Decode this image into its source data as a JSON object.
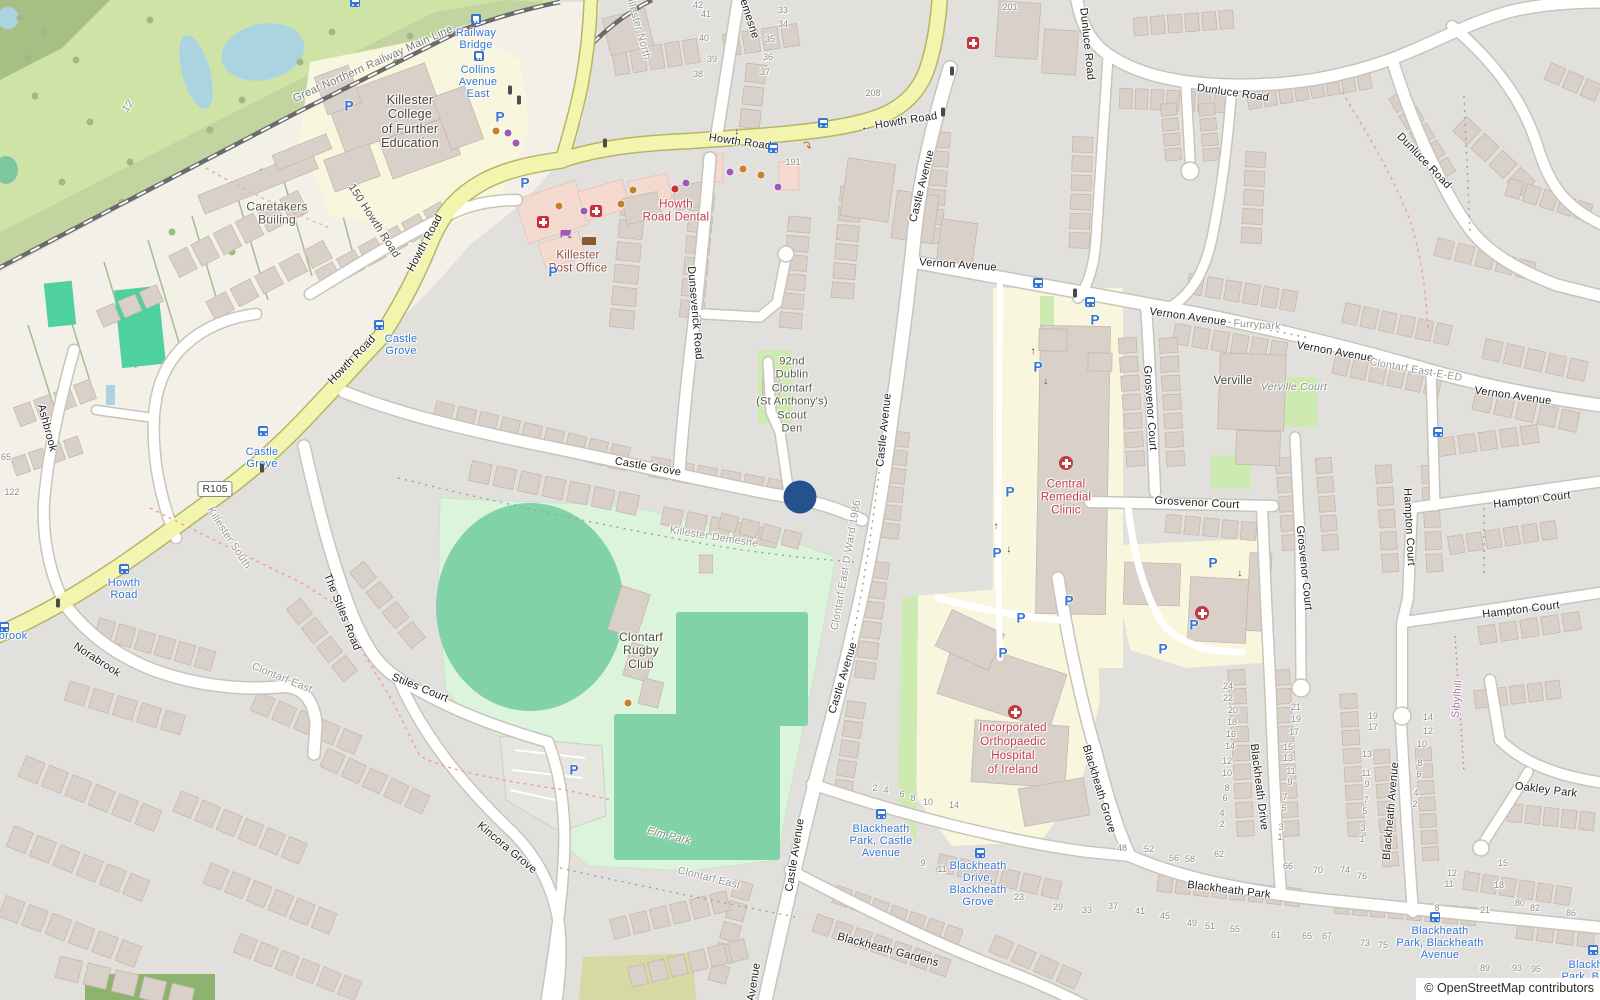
{
  "attribution": "© OpenStreetMap contributors",
  "shield": {
    "text": "R105",
    "x": 215,
    "y": 489
  },
  "marker": {
    "x": 800,
    "y": 497,
    "color": "#26518f"
  },
  "palette": {
    "road_major": "#f3f5ae",
    "road_minor": "#ffffff",
    "residential": "#e2e0dd",
    "land": "#f3f0e8",
    "golf": "#cfe3a7",
    "sports_ground": "#dcf3dc",
    "pitch": "#82d2a8",
    "institution_ground": "#f8f6dc",
    "water": "#abd4e0",
    "building": "#d9d0c9",
    "retail_building": "#f4d9ce",
    "transit_blue": "#3575d4",
    "poi_red": "#c13b47",
    "marker_blue": "#26518f",
    "boundary_red": "#ef9aa6"
  },
  "street_labels": [
    {
      "t": "Great Northern Railway Main Line",
      "x": 373,
      "y": 64,
      "r": -24,
      "c": "#7a7a74"
    },
    {
      "t": "Howth Road",
      "x": 425,
      "y": 243,
      "r": -62
    },
    {
      "t": "150 Howth Road",
      "x": 374,
      "y": 221,
      "r": 57,
      "c": "#4c4c44"
    },
    {
      "t": "Howth Road",
      "x": 352,
      "y": 360,
      "r": -46
    },
    {
      "t": "Howth Road",
      "x": 740,
      "y": 142,
      "r": 8
    },
    {
      "t": "← Howth Road",
      "x": 899,
      "y": 122,
      "r": -9
    },
    {
      "t": "Demesne",
      "x": 748,
      "y": 15,
      "r": 72
    },
    {
      "t": "Dunseverick Road",
      "x": 695,
      "y": 313,
      "r": 85
    },
    {
      "t": "Castle Avenue",
      "x": 922,
      "y": 186,
      "r": -76
    },
    {
      "t": "Castle Avenue",
      "x": 884,
      "y": 430,
      "r": -84
    },
    {
      "t": "Castle Avenue",
      "x": 843,
      "y": 678,
      "r": -73
    },
    {
      "t": "Castle Avenue",
      "x": 795,
      "y": 855,
      "r": -81
    },
    {
      "t": "Avenue",
      "x": 754,
      "y": 982,
      "r": -81
    },
    {
      "t": "Castle Grove",
      "x": 648,
      "y": 467,
      "r": 10
    },
    {
      "t": "Vernon Avenue",
      "x": 958,
      "y": 265,
      "r": 4
    },
    {
      "t": "Vernon Avenue",
      "x": 1188,
      "y": 317,
      "r": 8
    },
    {
      "t": "Vernon Avenue",
      "x": 1335,
      "y": 352,
      "r": 10
    },
    {
      "t": "Vernon Avenue",
      "x": 1513,
      "y": 396,
      "r": 8
    },
    {
      "t": "Dunluce Road",
      "x": 1087,
      "y": 44,
      "r": 84
    },
    {
      "t": "Dunluce Road",
      "x": 1233,
      "y": 93,
      "r": 8
    },
    {
      "t": "Dunluce Road",
      "x": 1424,
      "y": 161,
      "r": 46
    },
    {
      "t": "Grosvenor Court",
      "x": 1150,
      "y": 408,
      "r": 86
    },
    {
      "t": "Grosvenor Court",
      "x": 1197,
      "y": 503,
      "r": 3
    },
    {
      "t": "Grosvenor Court",
      "x": 1304,
      "y": 568,
      "r": 84
    },
    {
      "t": "Hampton Court",
      "x": 1532,
      "y": 500,
      "r": -7
    },
    {
      "t": "Hampton Court",
      "x": 1521,
      "y": 610,
      "r": -7
    },
    {
      "t": "Hampton Court",
      "x": 1409,
      "y": 527,
      "r": 87
    },
    {
      "t": "The Stiles Road",
      "x": 342,
      "y": 612,
      "r": 68
    },
    {
      "t": "Stiles Court",
      "x": 420,
      "y": 688,
      "r": 22
    },
    {
      "t": "Kincora Grove",
      "x": 507,
      "y": 848,
      "r": 40
    },
    {
      "t": "Norabrook",
      "x": 97,
      "y": 660,
      "r": 33
    },
    {
      "t": "Ashbrook",
      "x": 47,
      "y": 428,
      "r": 75
    },
    {
      "t": "Blackheath Grove",
      "x": 1099,
      "y": 789,
      "r": 73
    },
    {
      "t": "Blackheath Drive",
      "x": 1259,
      "y": 787,
      "r": 83
    },
    {
      "t": "Blackheath Park",
      "x": 1229,
      "y": 890,
      "r": 7
    },
    {
      "t": "Blackheath Gardens",
      "x": 888,
      "y": 950,
      "r": 15
    },
    {
      "t": "Blackheath Avenue",
      "x": 1391,
      "y": 811,
      "r": -85
    },
    {
      "t": "Oakley Park",
      "x": 1546,
      "y": 790,
      "r": 7
    }
  ],
  "area_labels": [
    {
      "t": "Killester North",
      "x": 638,
      "y": 26,
      "r": 74
    },
    {
      "t": "Killester South",
      "x": 229,
      "y": 538,
      "r": 57
    },
    {
      "t": "Killester Demesne",
      "x": 714,
      "y": 537,
      "r": 9
    },
    {
      "t": "Clontarf East",
      "x": 282,
      "y": 678,
      "r": 22
    },
    {
      "t": "Clontarf East",
      "x": 709,
      "y": 878,
      "r": 14
    },
    {
      "t": "Clontarf East-D Ward 1986",
      "x": 846,
      "y": 565,
      "r": -80
    },
    {
      "t": "Clontarf East-E-ED",
      "x": 1416,
      "y": 370,
      "r": 10
    },
    {
      "t": "Furrypark",
      "x": 1257,
      "y": 325,
      "r": 4
    },
    {
      "t": "Sibylhill",
      "x": 1457,
      "y": 699,
      "r": -85,
      "c": "#a8719c"
    },
    {
      "t": "Elm Park",
      "x": 669,
      "y": 836,
      "r": 14,
      "c": "#7d8d78",
      "i": 1
    },
    {
      "t": "Verville Court",
      "x": 1294,
      "y": 387,
      "r": 0,
      "c": "#8b8b83",
      "i": 1
    },
    {
      "t": "12",
      "x": 128,
      "y": 106,
      "r": -55,
      "c": "#8a9a72"
    }
  ],
  "poi_labels": [
    {
      "lines": [
        "Killester",
        "College",
        "of Further",
        "Education"
      ],
      "x": 410,
      "y": 100,
      "lh": 14.5,
      "s": 12.5,
      "c": "#45453b"
    },
    {
      "lines": [
        "Caretakers",
        "Builing"
      ],
      "x": 277,
      "y": 207,
      "lh": 13.5,
      "s": 12,
      "c": "#55554b"
    },
    {
      "lines": [
        "Killester",
        "Post Office"
      ],
      "x": 578,
      "y": 256,
      "lh": 12.5,
      "s": 11.5,
      "c": "#8a4a36"
    },
    {
      "lines": [
        "Howth",
        "Road Dental"
      ],
      "x": 676,
      "y": 205,
      "lh": 12.5,
      "s": 11.5,
      "c": "#c13b47"
    },
    {
      "lines": [
        "Central",
        "Remedial",
        "Clinic"
      ],
      "x": 1066,
      "y": 485,
      "lh": 13,
      "s": 11.5,
      "c": "#c13b47"
    },
    {
      "lines": [
        "Incorporated",
        "Orthopaedic",
        "Hospital",
        "of Ireland"
      ],
      "x": 1013,
      "y": 728,
      "lh": 14,
      "s": 11.5,
      "c": "#c13b47"
    },
    {
      "lines": [
        "Clontarf",
        "Rugby",
        "Club"
      ],
      "x": 641,
      "y": 637,
      "lh": 13.5,
      "s": 12,
      "c": "#4a4a3e"
    },
    {
      "lines": [
        "92nd",
        "Dublin",
        "Clontarf",
        "(St Anthony's)",
        "Scout",
        "Den"
      ],
      "x": 792,
      "y": 362,
      "lh": 13.5,
      "s": 11,
      "c": "#54544a"
    },
    {
      "lines": [
        "Verville"
      ],
      "x": 1233,
      "y": 381,
      "lh": 12,
      "s": 11.5,
      "c": "#45453b"
    }
  ],
  "transit_labels": [
    {
      "lines": [
        "Railway",
        "Bridge"
      ],
      "x": 476,
      "y": 33
    },
    {
      "lines": [
        "Collins",
        "Avenue",
        "East"
      ],
      "x": 478,
      "y": 70
    },
    {
      "lines": [
        "Castle",
        "Grove"
      ],
      "x": 401,
      "y": 339
    },
    {
      "lines": [
        "Castle",
        "Grove"
      ],
      "x": 262,
      "y": 452
    },
    {
      "lines": [
        "Howth",
        "Road"
      ],
      "x": 124,
      "y": 583
    },
    {
      "lines": [
        "brook"
      ],
      "x": 13,
      "y": 636
    },
    {
      "lines": [
        "Blackheath",
        "Park, Castle",
        "Avenue"
      ],
      "x": 881,
      "y": 829
    },
    {
      "lines": [
        "Blackheath",
        "Drive,",
        "Blackheath",
        "Grove"
      ],
      "x": 978,
      "y": 866
    },
    {
      "lines": [
        "Blackheath",
        "Park, Blackheath",
        "Avenue"
      ],
      "x": 1440,
      "y": 931
    },
    {
      "lines": [
        "Blackheath",
        "Park, Blackhe"
      ],
      "x": 1597,
      "y": 965
    }
  ],
  "house_numbers": [
    [
      698,
      5,
      "42"
    ],
    [
      706,
      14,
      "41"
    ],
    [
      704,
      38,
      "40"
    ],
    [
      712,
      59,
      "39"
    ],
    [
      698,
      74,
      "38"
    ],
    [
      783,
      10,
      "33"
    ],
    [
      783,
      24,
      "34"
    ],
    [
      770,
      39,
      "35"
    ],
    [
      768,
      57,
      "36"
    ],
    [
      765,
      72,
      "37"
    ],
    [
      873,
      93,
      "208"
    ],
    [
      1010,
      7,
      "201"
    ],
    [
      793,
      162,
      "191"
    ],
    [
      12,
      492,
      "122"
    ],
    [
      6,
      457,
      "65"
    ],
    [
      1228,
      686,
      "24"
    ],
    [
      1228,
      698,
      "22"
    ],
    [
      1233,
      710,
      "20"
    ],
    [
      1232,
      722,
      "18"
    ],
    [
      1231,
      734,
      "16"
    ],
    [
      1230,
      746,
      "14"
    ],
    [
      1227,
      761,
      "12"
    ],
    [
      1227,
      773,
      "10"
    ],
    [
      1227,
      788,
      "8"
    ],
    [
      1225,
      798,
      "6"
    ],
    [
      1222,
      813,
      "4"
    ],
    [
      1222,
      824,
      "2"
    ],
    [
      1296,
      707,
      "21"
    ],
    [
      1296,
      719,
      "19"
    ],
    [
      1294,
      732,
      "17"
    ],
    [
      1288,
      747,
      "15"
    ],
    [
      1288,
      758,
      "13"
    ],
    [
      1291,
      771,
      "11"
    ],
    [
      1290,
      782,
      "9"
    ],
    [
      1285,
      797,
      "7"
    ],
    [
      1284,
      808,
      "5"
    ],
    [
      1281,
      827,
      "3"
    ],
    [
      1280,
      837,
      "1"
    ],
    [
      1373,
      716,
      "19"
    ],
    [
      1373,
      727,
      "17"
    ],
    [
      1367,
      754,
      "13"
    ],
    [
      1366,
      773,
      "11"
    ],
    [
      1367,
      784,
      "9"
    ],
    [
      1366,
      800,
      "7"
    ],
    [
      1365,
      811,
      "5"
    ],
    [
      1363,
      828,
      "3"
    ],
    [
      1362,
      839,
      "1"
    ],
    [
      1428,
      717,
      "14"
    ],
    [
      1428,
      731,
      "12"
    ],
    [
      1422,
      744,
      "10"
    ],
    [
      1420,
      763,
      "8"
    ],
    [
      1419,
      774,
      "6"
    ],
    [
      1416,
      793,
      "4"
    ],
    [
      1415,
      804,
      "2"
    ],
    [
      1452,
      873,
      "12"
    ],
    [
      1449,
      884,
      "11"
    ],
    [
      1437,
      908,
      "8"
    ],
    [
      1503,
      863,
      "15"
    ],
    [
      1499,
      885,
      "18"
    ],
    [
      1485,
      910,
      "21"
    ],
    [
      1520,
      903,
      "80"
    ],
    [
      1535,
      908,
      "82"
    ],
    [
      1571,
      913,
      "86"
    ],
    [
      1122,
      848,
      "48"
    ],
    [
      1149,
      849,
      "52"
    ],
    [
      1174,
      858,
      "56"
    ],
    [
      1190,
      859,
      "58"
    ],
    [
      1219,
      854,
      "62"
    ],
    [
      1288,
      866,
      "66"
    ],
    [
      1318,
      870,
      "70"
    ],
    [
      1345,
      870,
      "74"
    ],
    [
      1362,
      876,
      "76"
    ],
    [
      1276,
      935,
      "61"
    ],
    [
      1307,
      936,
      "65"
    ],
    [
      1327,
      936,
      "67"
    ],
    [
      1365,
      943,
      "73"
    ],
    [
      1383,
      945,
      "75"
    ],
    [
      1485,
      968,
      "89"
    ],
    [
      1517,
      968,
      "93"
    ],
    [
      1536,
      969,
      "95"
    ],
    [
      875,
      788,
      "2"
    ],
    [
      886,
      790,
      "4"
    ],
    [
      902,
      794,
      "6"
    ],
    [
      913,
      798,
      "8"
    ],
    [
      928,
      802,
      "10"
    ],
    [
      954,
      805,
      "14"
    ],
    [
      923,
      863,
      "9"
    ],
    [
      942,
      869,
      "11"
    ],
    [
      1019,
      897,
      "23"
    ],
    [
      1058,
      907,
      "29"
    ],
    [
      1087,
      910,
      "33"
    ],
    [
      1113,
      906,
      "37"
    ],
    [
      1140,
      911,
      "41"
    ],
    [
      1165,
      916,
      "45"
    ],
    [
      1192,
      923,
      "49"
    ],
    [
      1210,
      926,
      "51"
    ],
    [
      1235,
      929,
      "55"
    ]
  ],
  "icons": {
    "parking": [
      [
        349,
        106
      ],
      [
        500,
        117
      ],
      [
        525,
        183
      ],
      [
        553,
        272
      ],
      [
        574,
        770
      ],
      [
        1095,
        320
      ],
      [
        1038,
        367
      ],
      [
        1010,
        492
      ],
      [
        997,
        553
      ],
      [
        1069,
        601
      ],
      [
        1021,
        618
      ],
      [
        1003,
        653
      ],
      [
        1163,
        649
      ],
      [
        1213,
        563
      ],
      [
        1194,
        625
      ]
    ],
    "bus": [
      [
        355,
        2
      ],
      [
        823,
        123
      ],
      [
        773,
        148
      ],
      [
        379,
        325
      ],
      [
        263,
        431
      ],
      [
        124,
        569
      ],
      [
        4,
        627
      ],
      [
        1038,
        283
      ],
      [
        1090,
        302
      ],
      [
        1438,
        432
      ],
      [
        881,
        814
      ],
      [
        980,
        853
      ],
      [
        1435,
        917
      ],
      [
        1593,
        950
      ]
    ],
    "rail": [
      [
        476,
        19
      ],
      [
        479,
        56
      ]
    ],
    "med_square": [
      [
        973,
        43
      ],
      [
        543,
        222
      ],
      [
        596,
        211
      ]
    ],
    "med_circle": [
      [
        1066,
        463
      ],
      [
        1015,
        712
      ],
      [
        1202,
        613
      ]
    ],
    "traffic": [
      [
        510,
        90
      ],
      [
        519,
        100
      ],
      [
        952,
        71
      ],
      [
        943,
        112
      ],
      [
        605,
        143
      ],
      [
        58,
        603
      ],
      [
        262,
        468
      ],
      [
        1075,
        293
      ]
    ],
    "dots": [
      [
        496,
        131,
        "o"
      ],
      [
        559,
        206,
        "o"
      ],
      [
        621,
        204,
        "o"
      ],
      [
        633,
        190,
        "o"
      ],
      [
        743,
        169,
        "o"
      ],
      [
        761,
        175,
        "o"
      ],
      [
        628,
        703,
        "o"
      ],
      [
        508,
        133,
        "p"
      ],
      [
        516,
        143,
        "p"
      ],
      [
        584,
        211,
        "p"
      ],
      [
        686,
        183,
        "p"
      ],
      [
        730,
        172,
        "p"
      ],
      [
        778,
        187,
        "p"
      ],
      [
        675,
        189,
        "r"
      ]
    ],
    "arrows": [
      [
        737,
        131,
        180
      ],
      [
        1033,
        352,
        0
      ],
      [
        1046,
        381,
        180
      ],
      [
        996,
        527,
        0
      ],
      [
        1009,
        549,
        180
      ],
      [
        1240,
        573,
        180
      ]
    ],
    "turn_arrow": {
      "x": 807,
      "y": 146,
      "t": "↷"
    },
    "cart": {
      "x": 566,
      "y": 234
    },
    "envelope": {
      "x": 589,
      "y": 240
    }
  }
}
